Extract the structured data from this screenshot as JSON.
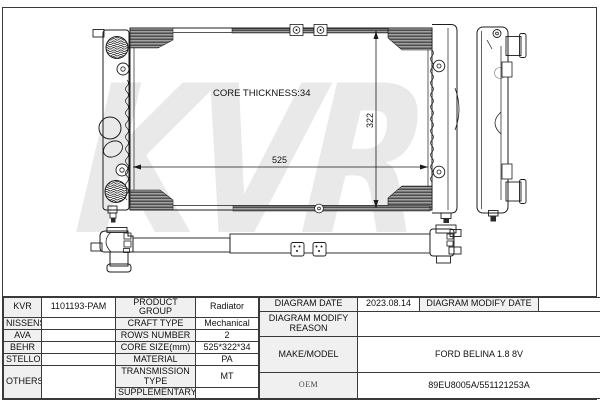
{
  "watermark": "KVR",
  "diagram": {
    "core_thickness_label": "CORE THICKNESS:34",
    "width_dimension": "525",
    "height_dimension": "322"
  },
  "table": {
    "left": {
      "rows": [
        {
          "brand": "KVR",
          "code": "1101193-PAM",
          "property": "PRODUCT GROUP",
          "value": "Radiator"
        },
        {
          "brand": "NISSENS",
          "code": "",
          "property": "CRAFT TYPE",
          "value": "Mechanical"
        },
        {
          "brand": "AVA",
          "code": "",
          "property": "ROWS NUMBER",
          "value": "2"
        },
        {
          "brand": "BEHR",
          "code": "",
          "property": "CORE SIZE(mm)",
          "value": "525*322*34"
        },
        {
          "brand": "STELLOX",
          "code": "",
          "property": "MATERIAL",
          "value": "PA"
        },
        {
          "brand": "OTHERS",
          "code": "",
          "property": "TRANSMISSION TYPE",
          "value": "MT"
        },
        {
          "property": "SUPPLEMENTARY",
          "value": ""
        }
      ]
    },
    "right": {
      "diagram_date_label": "DIAGRAM DATE",
      "diagram_date": "2023.08.14",
      "diagram_modify_date_label": "DIAGRAM MODIFY DATE",
      "diagram_modify_date": "",
      "diagram_modify_reason_label": "DIAGRAM MODIFY REASON",
      "diagram_modify_reason": "",
      "make_model_label": "MAKE/MODEL",
      "make_model": "FORD BELINA 1.8 8V",
      "oem_label": "OEM",
      "oem": "89EU8005A/551121253A"
    }
  }
}
